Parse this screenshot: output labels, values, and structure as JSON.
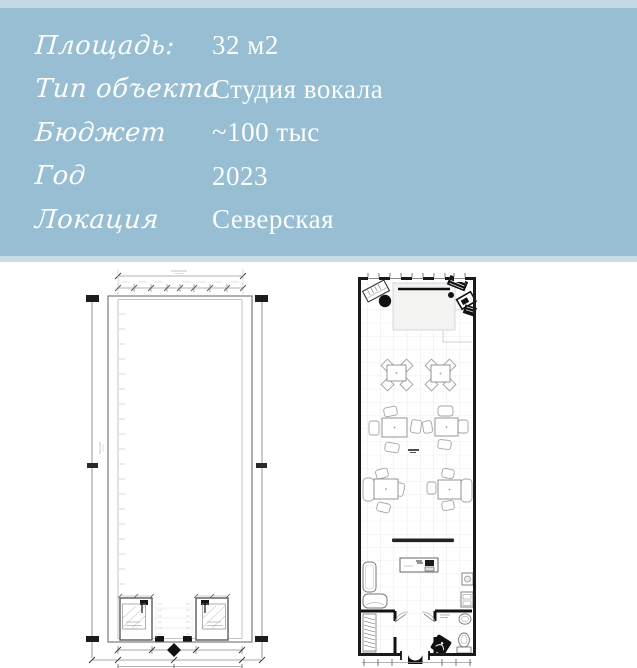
{
  "header": {
    "bg_color": "#97bed2",
    "strip_top_color": "#c3d9e4",
    "strip_bottom_color": "#cadde7",
    "text_color": "#fdfdfd",
    "rows": [
      {
        "label": "Площадь:",
        "value": "32 м2"
      },
      {
        "label": "Тип объекта",
        "value": "Студия вокала"
      },
      {
        "label": "Бюджет",
        "value": "~100 тыс"
      },
      {
        "label": "Год",
        "value": "2023"
      },
      {
        "label": "Локация",
        "value": "Северская"
      }
    ]
  },
  "plans": {
    "left_plan": "measured-empty-floor-plan",
    "right_plan": "furnished-floor-plan"
  }
}
